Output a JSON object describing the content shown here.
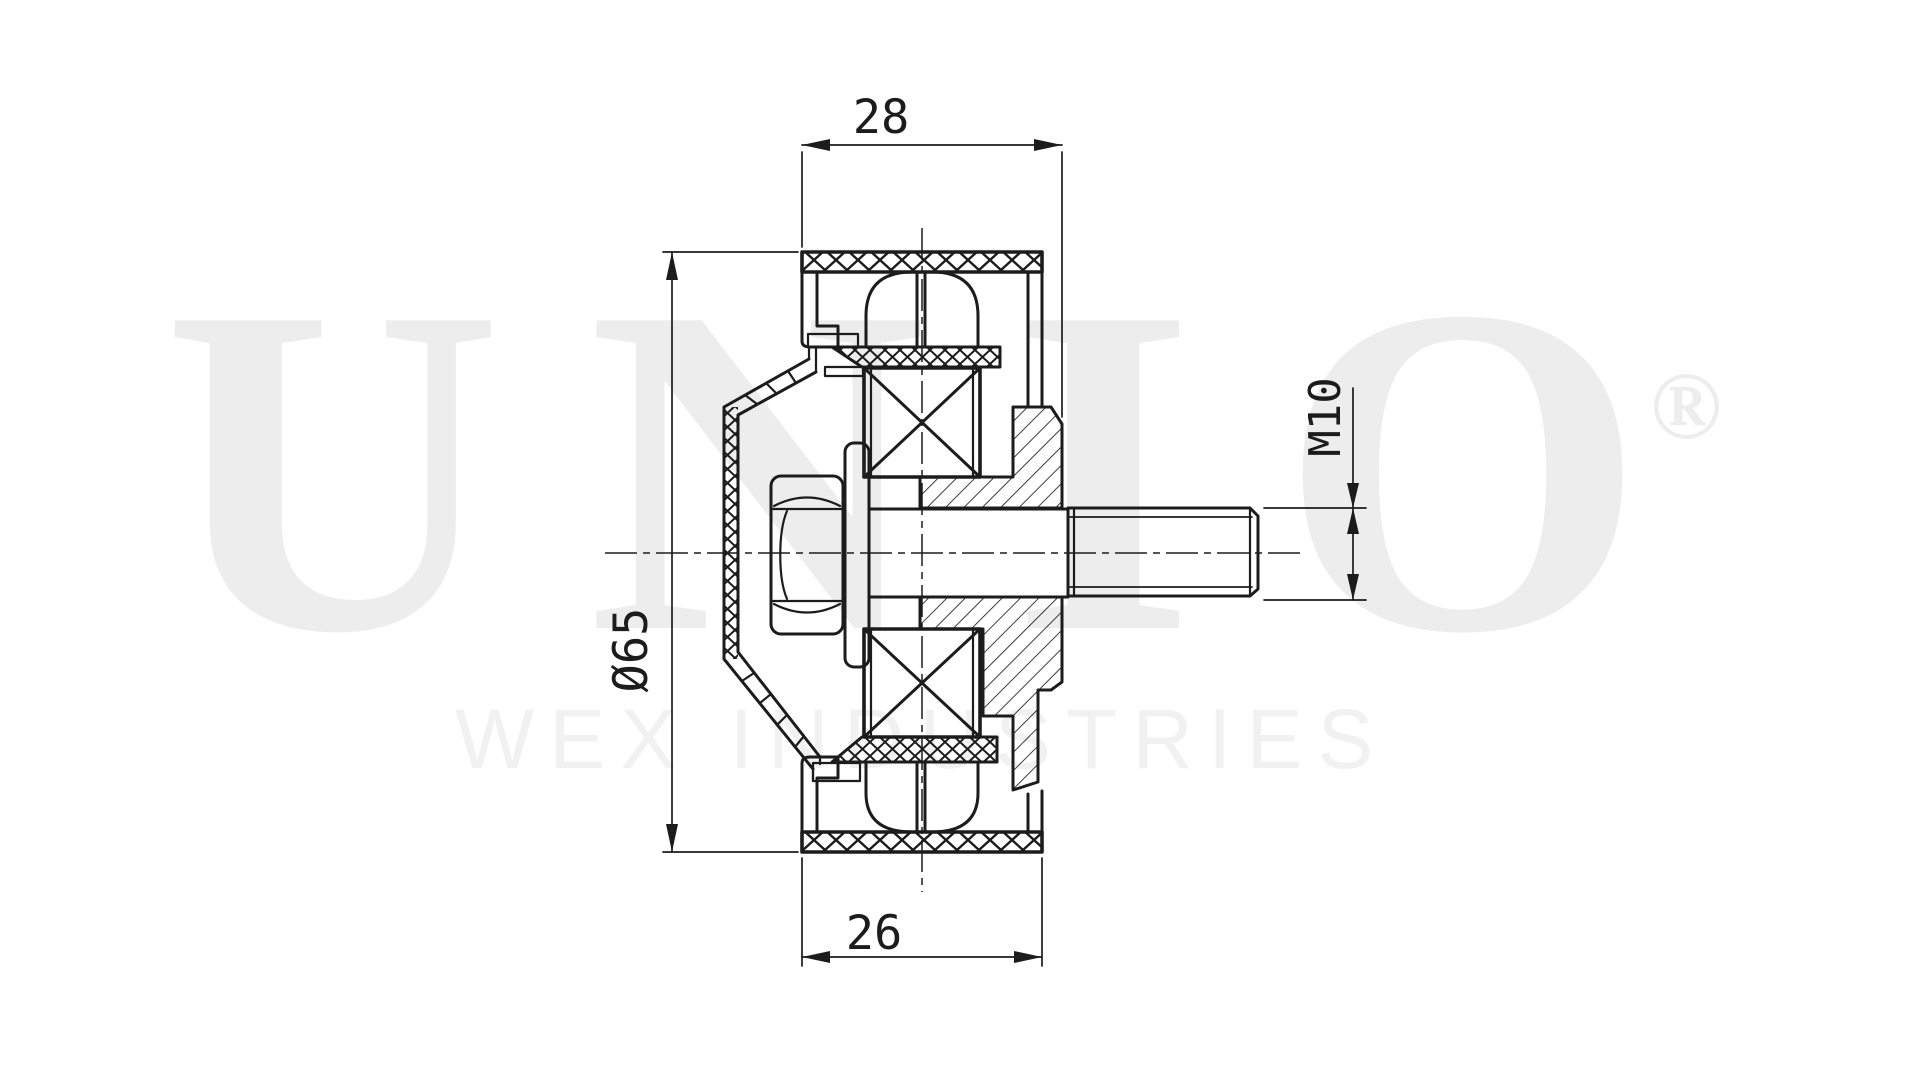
{
  "colors": {
    "background": "#ffffff",
    "line": "#1c1c1c",
    "watermark": "#ededed",
    "watermark_subtitle": "#f1f1f1"
  },
  "watermark": {
    "brand": "UNIO",
    "registered_mark": "®",
    "subtitle": "WEX INDUSTRIES"
  },
  "drawing": {
    "view": "side cross-section of a belt idler pulley with threaded stud",
    "dimensions": {
      "top_width": {
        "label": "28"
      },
      "bottom_width": {
        "label": "26"
      },
      "outer_diameter": {
        "label": "Ø65"
      },
      "thread": {
        "label": "M10"
      }
    }
  }
}
